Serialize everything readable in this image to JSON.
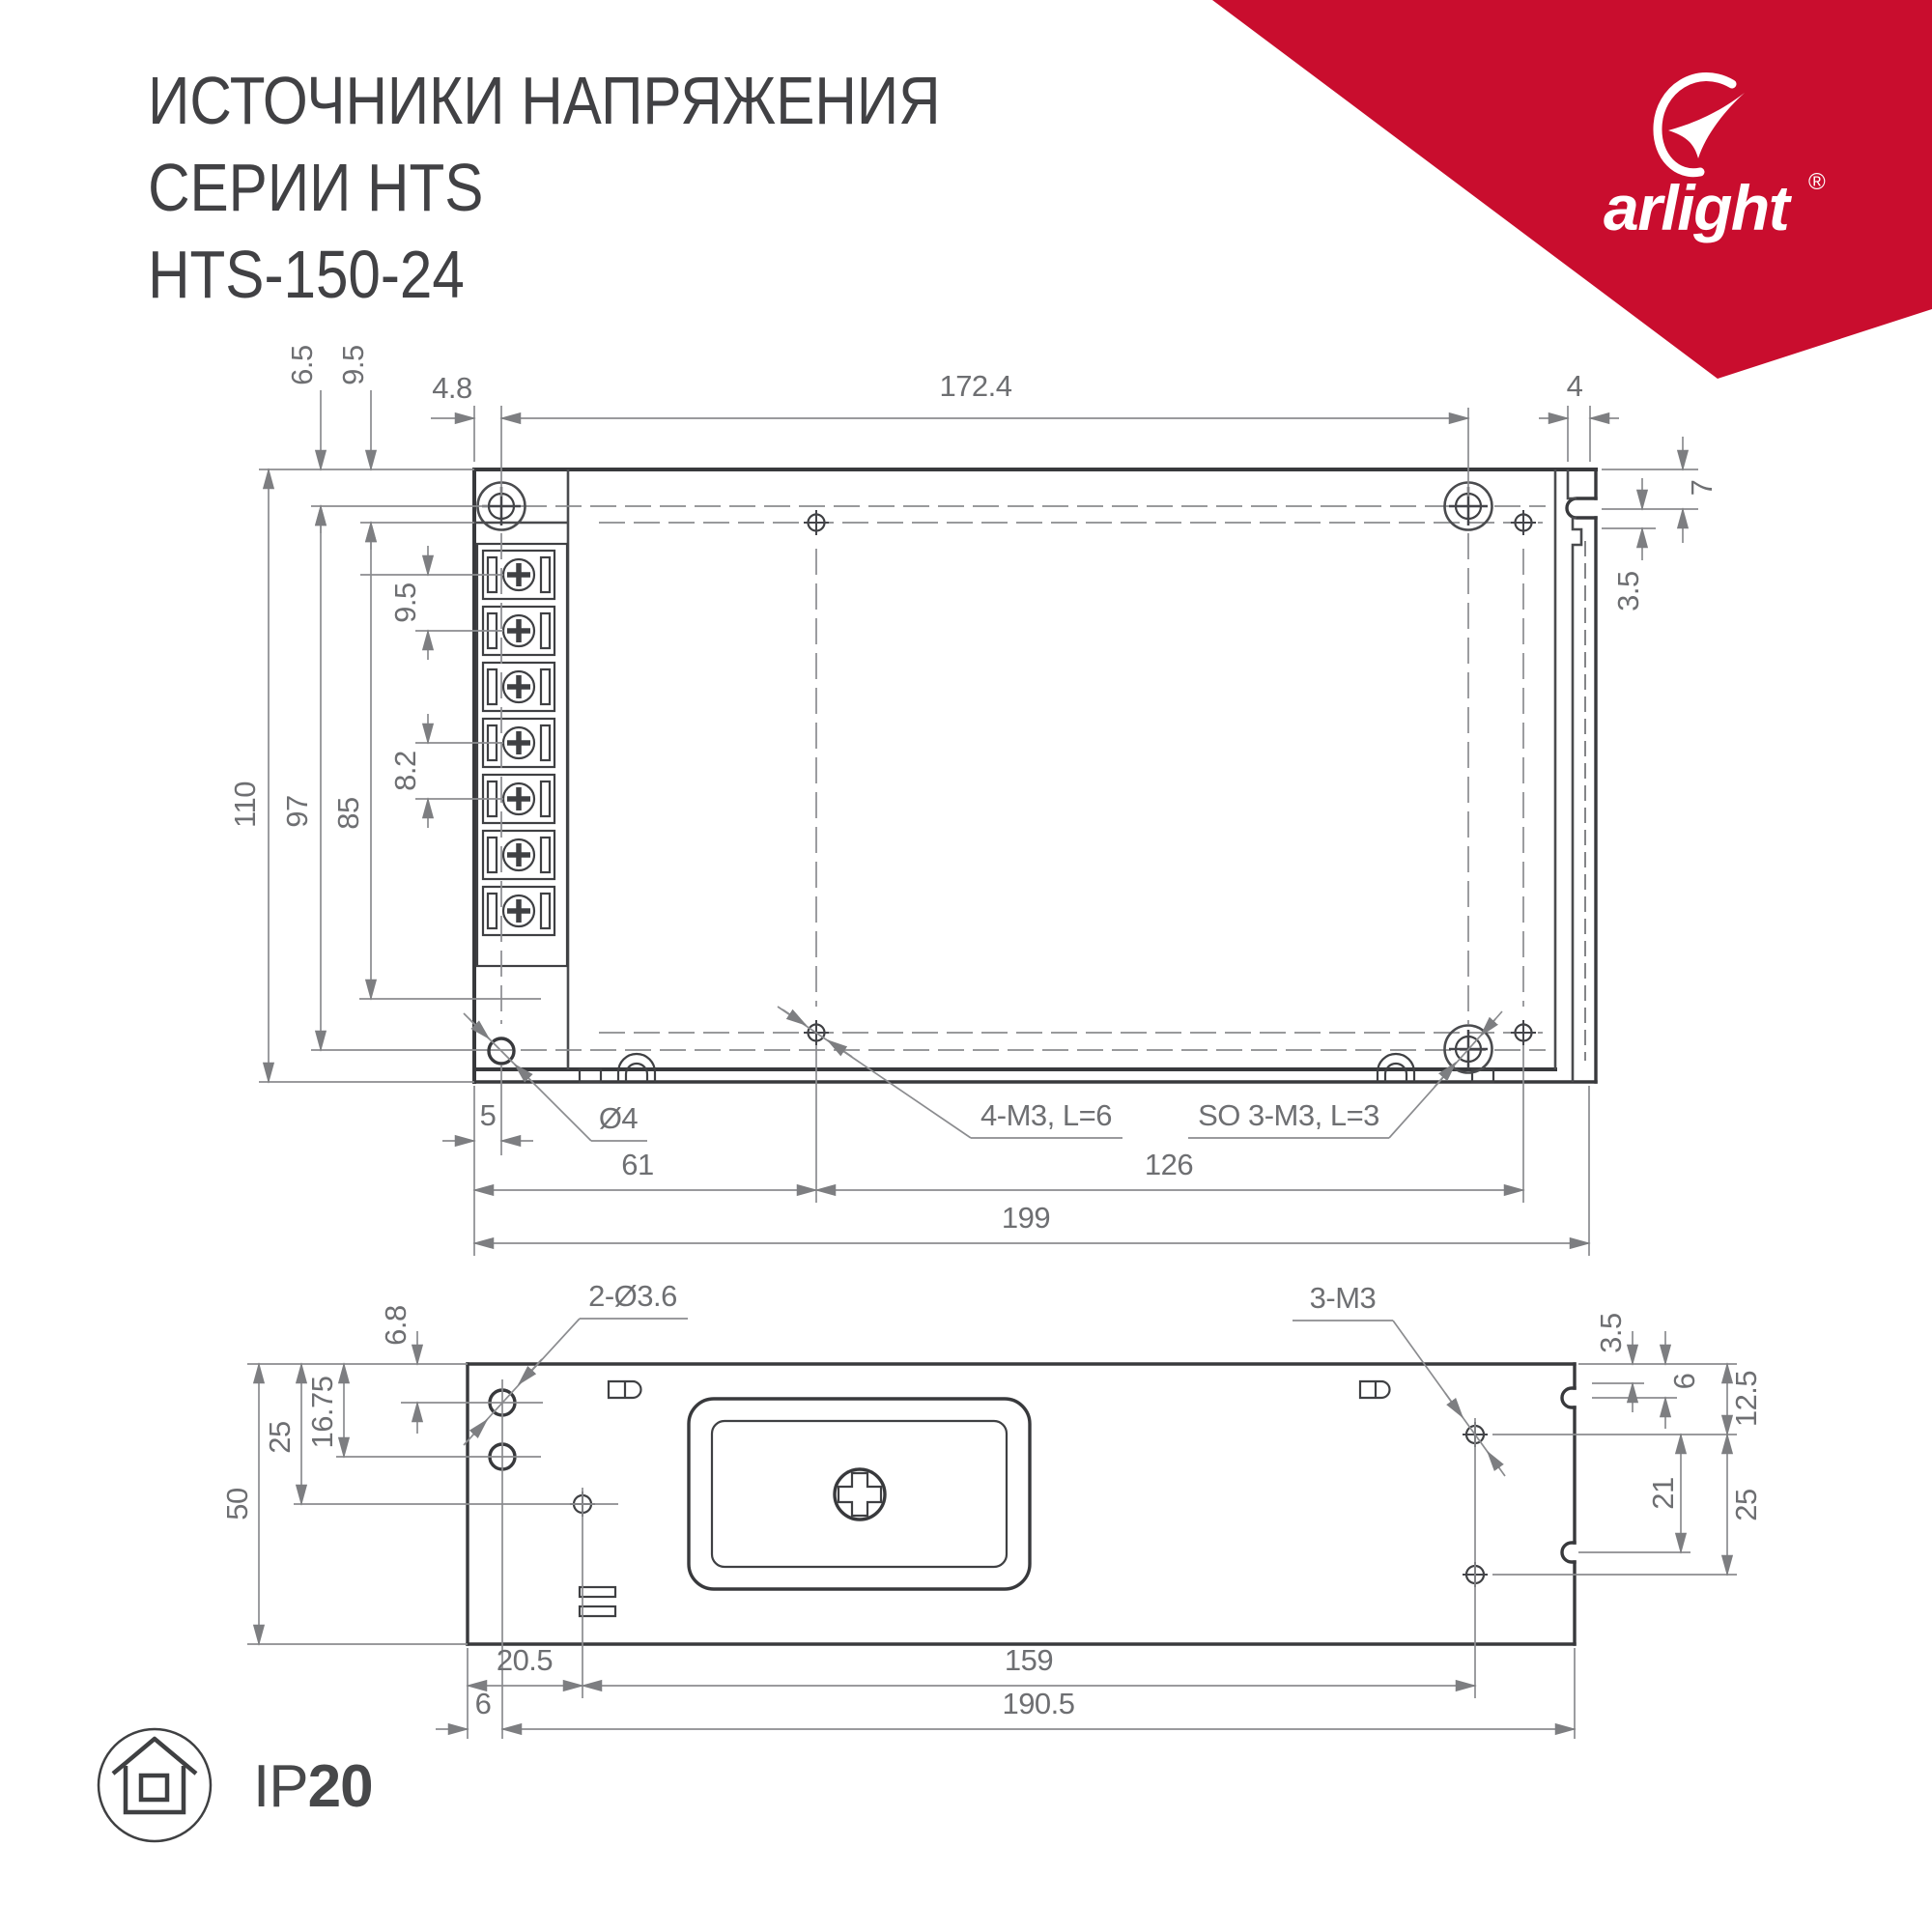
{
  "title": {
    "line1": "ИСТОЧНИКИ НАПРЯЖЕНИЯ",
    "line2": "СЕРИИ HTS",
    "line3": "HTS-150-24"
  },
  "brand": {
    "name": "arlight",
    "registered": "®"
  },
  "ip_badge": {
    "prefix": "IP",
    "value": "20"
  },
  "colors": {
    "accent_red": "#C90D2E",
    "line_dark": "#38393c",
    "line_dim": "#8b8c8f",
    "text_dim": "#6e6f72",
    "text_dark": "#414144"
  },
  "top_view": {
    "dims": {
      "d4_8": "4.8",
      "d172_4": "172.4",
      "d4": "4",
      "d6_5": "6.5",
      "d9_5": "9.5",
      "d110": "110",
      "d97": "97",
      "d85": "85",
      "p9_5": "9.5",
      "p8_2": "8.2",
      "d7": "7",
      "d3_5": "3.5",
      "d5": "5",
      "d61": "61",
      "d126": "126",
      "d199": "199"
    },
    "labels": {
      "hole_d4": "Ø4",
      "screws_4m3": "4-M3, L=6",
      "standoffs": "SO 3-M3, L=3"
    }
  },
  "side_view": {
    "dims": {
      "d6_8": "6.8",
      "d50": "50",
      "d25l": "25",
      "d16_75": "16.75",
      "d3_5": "3.5",
      "d6r": "6",
      "d12_5": "12.5",
      "d21": "21",
      "d25r": "25",
      "d20_5": "20.5",
      "d159": "159",
      "d6b": "6",
      "d190_5": "190.5"
    },
    "labels": {
      "holes": "2-Ø3.6",
      "screws": "3-M3"
    }
  }
}
